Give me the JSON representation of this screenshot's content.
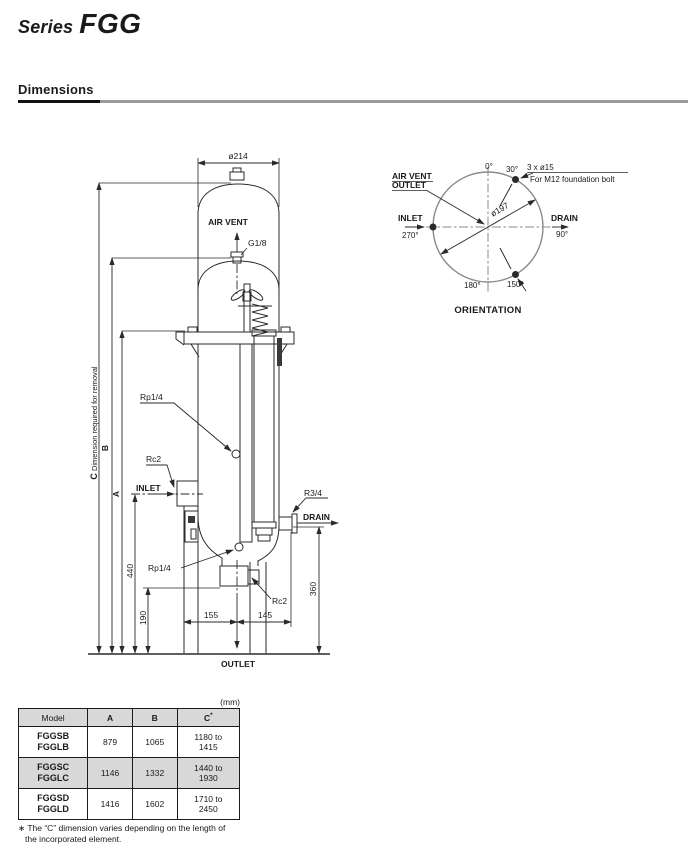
{
  "page": {
    "title_series": "Series",
    "title_model": "FGG",
    "section_heading": "Dimensions"
  },
  "drawing": {
    "dim_diameter": "ø214",
    "air_vent": "AIR VENT",
    "g18": "G1/8",
    "dim_c_letter": "C",
    "dim_c_note": "  Dimension required for removal",
    "dim_b": "B",
    "dim_a": "A",
    "rp14_upper": "Rp1/4",
    "rc2_inlet": "Rc2",
    "inlet": "INLET",
    "dim_440": "440",
    "dim_190": "190",
    "rp14_lower": "Rp1/4",
    "dim_155": "155",
    "dim_145": "145",
    "rc2_outlet": "Rc2",
    "r34": "R3/4",
    "drain": "DRAIN",
    "dim_360": "360",
    "outlet": "OUTLET"
  },
  "orientation": {
    "label_line1": "AIR VENT",
    "label_line2": "OUTLET",
    "deg0": "0°",
    "deg30": "30°",
    "bolt_note": "3 x ø15",
    "bolt_note2": "For M12 foundation bolt",
    "bolt_circle": "ø197",
    "inlet": "INLET",
    "deg270": "270°",
    "drain": "DRAIN",
    "deg90": "90°",
    "deg180": "180°",
    "deg150": "150°",
    "caption": "ORIENTATION"
  },
  "table": {
    "unit": "(mm)",
    "headers": {
      "model": "Model",
      "a": "A",
      "b": "B",
      "c": "C",
      "c_sup": "*"
    },
    "rows": [
      {
        "model1": "FGGSB",
        "model2": "FGGLB",
        "a": "879",
        "b": "1065",
        "c1": "1180 to",
        "c2": "1415"
      },
      {
        "model1": "FGGSC",
        "model2": "FGGLC",
        "a": "1146",
        "b": "1332",
        "c1": "1440 to",
        "c2": "1930"
      },
      {
        "model1": "FGGSD",
        "model2": "FGGLD",
        "a": "1416",
        "b": "1602",
        "c1": "1710 to",
        "c2": "2450"
      }
    ],
    "footnote_line1": "∗ The “C” dimension varies depending on the length of",
    "footnote_line2": "the incorporated element."
  },
  "colors": {
    "line": "#2a2a2a",
    "table_shading": "#d8d8d8",
    "element_fill": "#b0b0b0",
    "rule_gray": "#9a9a9a"
  }
}
